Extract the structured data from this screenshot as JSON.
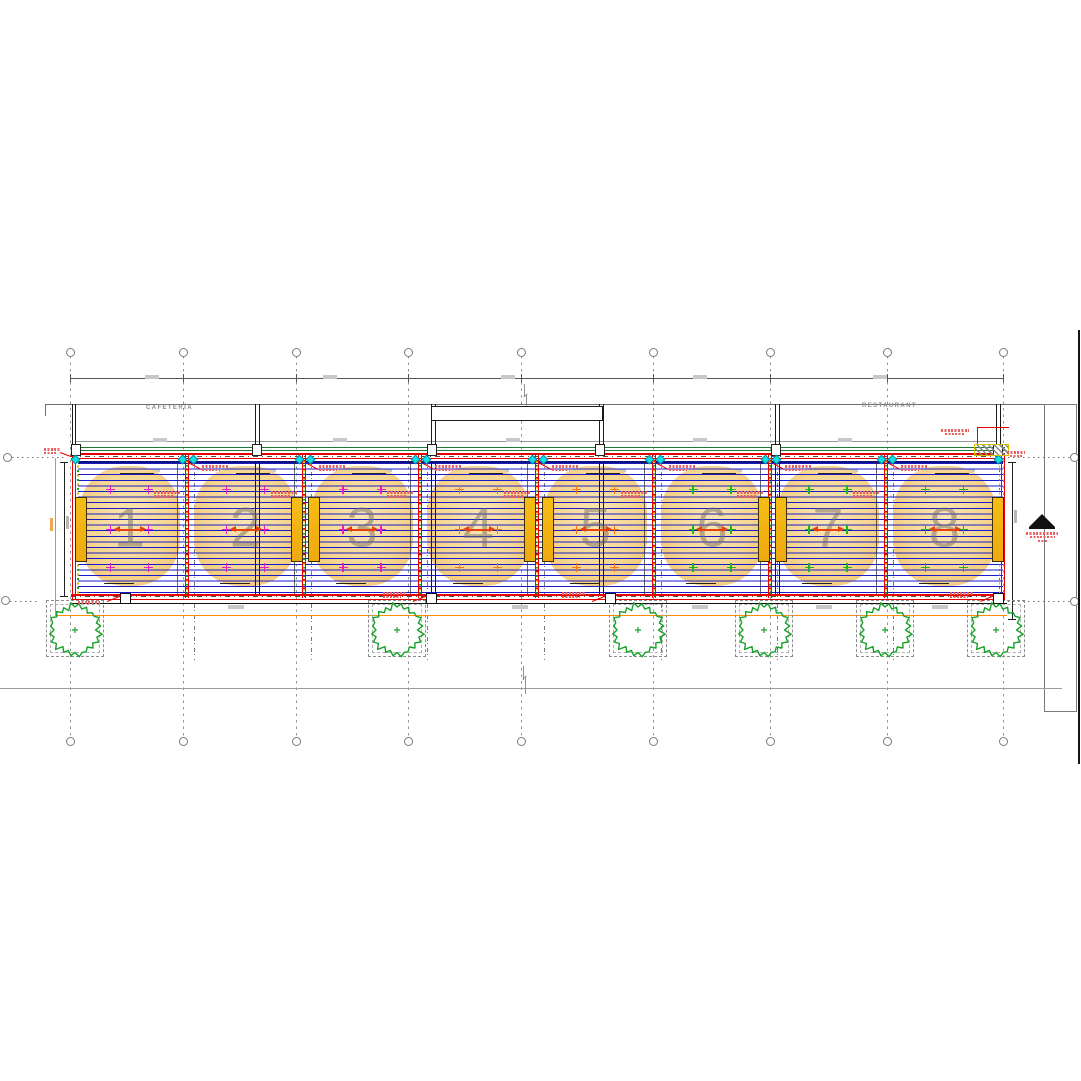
{
  "labels": {
    "cafeteria": "CAFETERÍA",
    "restaurant": "RESTAURANT"
  },
  "colors": {
    "deck_line_blue": "#1a1ac8",
    "structure_red": "#e60000",
    "green_band": "#1d7a32",
    "orange_dim": "#ff8c00",
    "heater_fill": "#f2b013",
    "blob_center": "#f9e6b4",
    "blob_edge": "#efbd62",
    "tree_green": "#16a228",
    "cyan_marker": "#10e0e8",
    "plus_magenta": "#e61ec8",
    "plus_orange": "#f07818",
    "plus_green": "#1eb41e",
    "arrow_red": "#e8420a",
    "grid_gray": "#949494"
  },
  "grid": {
    "columns": [
      70,
      183,
      296,
      408,
      521,
      653,
      770,
      887,
      1003
    ],
    "row_bubbles_y": [
      457,
      600
    ]
  },
  "bays": [
    {
      "number": "1",
      "x0": 72,
      "x1": 187,
      "plus": "#e61ec8"
    },
    {
      "number": "2",
      "x0": 187,
      "x1": 304,
      "plus": "#e61ec8"
    },
    {
      "number": "3",
      "x0": 304,
      "x1": 420,
      "plus": "#e61ec8"
    },
    {
      "number": "4",
      "x0": 420,
      "x1": 537,
      "plus": "#f07818"
    },
    {
      "number": "5",
      "x0": 537,
      "x1": 654,
      "plus": "#f07818"
    },
    {
      "number": "6",
      "x0": 654,
      "x1": 770,
      "plus": "#1eb41e"
    },
    {
      "number": "7",
      "x0": 770,
      "x1": 886,
      "plus": "#1eb41e"
    },
    {
      "number": "8",
      "x0": 886,
      "x1": 1003,
      "plus": "#1eb41e"
    }
  ],
  "dividers": [
    187,
    304,
    420,
    537,
    654,
    770,
    886
  ],
  "heaters": [
    75,
    291,
    308,
    524,
    542,
    758,
    775,
    992
  ],
  "wall_posts": [
    [
      72,
      75
    ],
    [
      255,
      259
    ],
    [
      431,
      435
    ],
    [
      599,
      603
    ],
    [
      775,
      779
    ],
    [
      996,
      1000
    ]
  ],
  "post_markers_top": [
    75,
    256,
    431,
    599,
    775,
    997
  ],
  "post_markers_bottom": [
    124,
    430,
    609,
    997
  ],
  "trees": [
    75,
    397,
    638,
    764,
    885,
    996
  ],
  "deck_smudges": [
    236,
    520,
    700,
    824,
    940
  ],
  "dim_smudges_top": [
    152,
    330,
    508,
    700,
    880
  ],
  "dim_smudges_mid": [
    160,
    340,
    513,
    700,
    845
  ]
}
